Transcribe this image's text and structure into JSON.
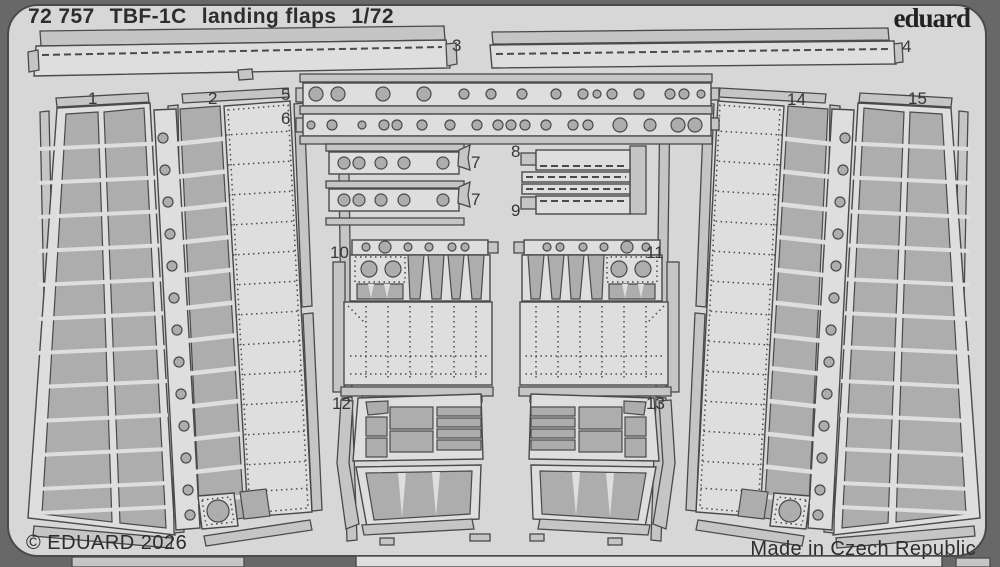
{
  "colors": {
    "bg": "#686868",
    "sheet": "#d7d7d7",
    "panel": "#dedede",
    "bar": "#c5c5c5",
    "etch": "#adadad",
    "outline": "#4a4a4a",
    "text": "#2d2d2d"
  },
  "header": {
    "catalog_number": "72 757",
    "aircraft": "TBF-1C",
    "subject": "landing flaps",
    "scale": "1/72",
    "brand": "eduard"
  },
  "footer": {
    "copyright": "© EDUARD 2026",
    "made_in": "Made in Czech Republic"
  },
  "labels": {
    "p1": "1",
    "p2": "2",
    "p3": "3",
    "p4": "4",
    "p5": "5",
    "p6": "6",
    "p7a": "7",
    "p7b": "7",
    "p8": "8",
    "p9": "9",
    "p10": "10",
    "p11": "11",
    "p12": "12",
    "p13": "13",
    "p14": "14",
    "p15": "15"
  }
}
